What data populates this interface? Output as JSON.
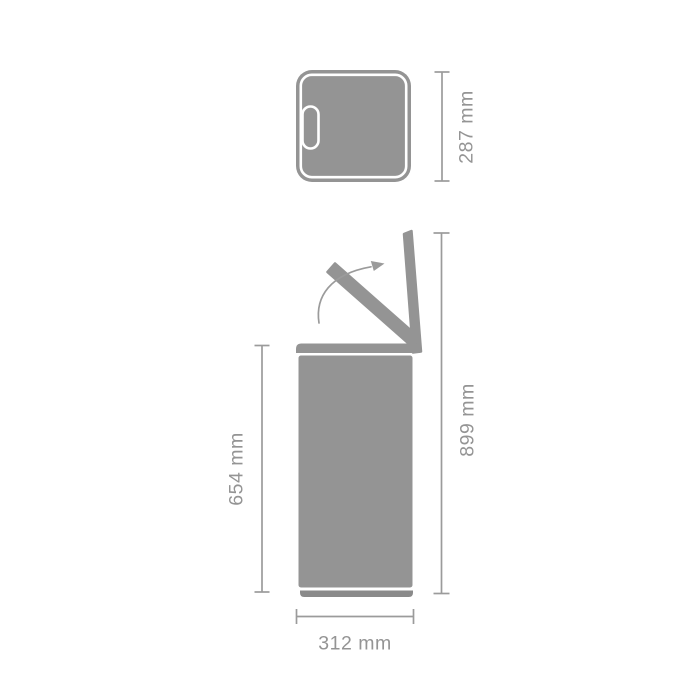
{
  "diagram": {
    "type": "product-dimension-drawing",
    "views": [
      "top-view",
      "side-view-lid-open"
    ],
    "labels": {
      "top_depth": "287 mm",
      "body_height": "654 mm",
      "total_height_open": "899 mm",
      "width": "312 mm"
    },
    "icons": {
      "rotation_arrow": "curved-arrow-up-right"
    },
    "colors": {
      "shape": "#949494",
      "base": "#8a8a8a",
      "outline": "#ffffff",
      "dimension": "#9b9b9b",
      "background": "#ffffff"
    }
  }
}
